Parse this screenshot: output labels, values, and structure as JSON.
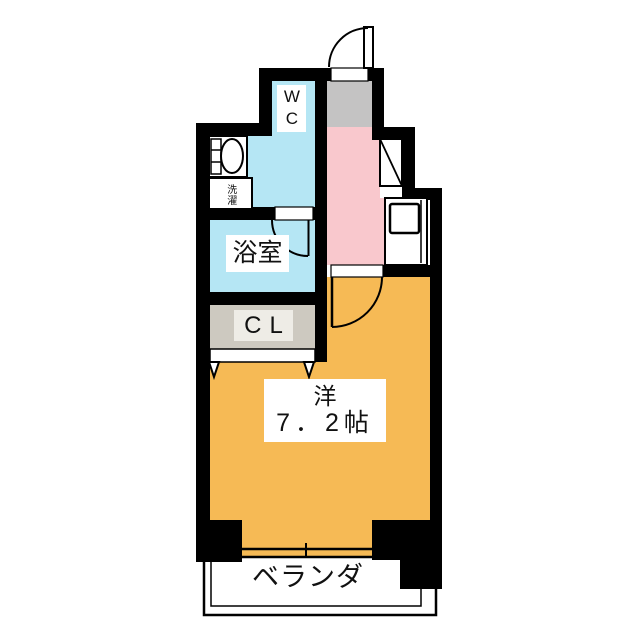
{
  "plan": {
    "title": "1K apartment floor plan",
    "rooms": {
      "wc": {
        "label": "WC"
      },
      "bathroom": {
        "label": "浴室"
      },
      "closet": {
        "label": "CL"
      },
      "laundry": {
        "label": "洗濯"
      },
      "living": {
        "name": "洋",
        "size": "7．2帖"
      },
      "balcony": {
        "label": "ベランダ"
      }
    },
    "colors": {
      "wall": "#000000",
      "water_area": "#b5e6f4",
      "kitchen": "#f9c8cd",
      "entry": "#c4c3c3",
      "living": "#f6ba55",
      "closet": "#cdc9c0",
      "closet_label_bg": "#eeece6",
      "fixture": "#ffffff"
    }
  }
}
